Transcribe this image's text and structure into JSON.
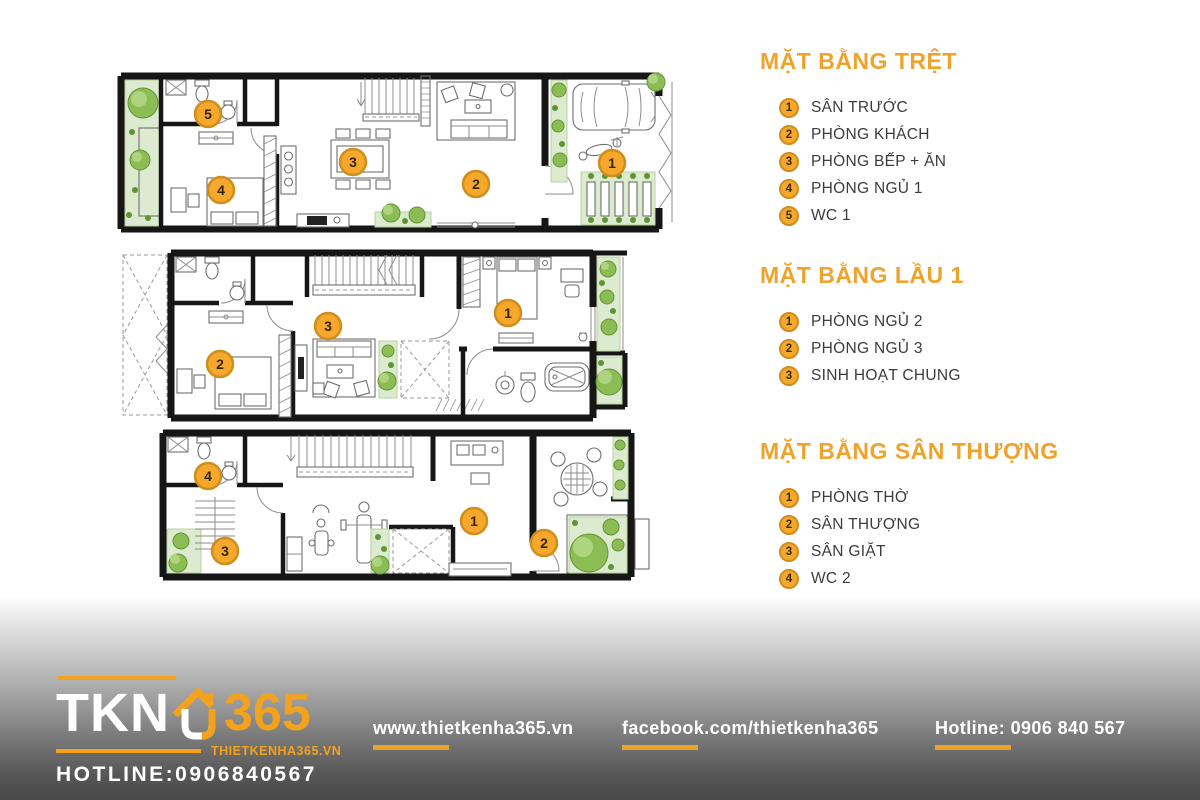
{
  "colors": {
    "accent": "#F0A42C",
    "marker_fill": "#F5A82B",
    "marker_border": "#CF8D1E",
    "legend_text": "#3C3C3C",
    "wall": "#161616",
    "garden_green": "#DCEAD0",
    "tree_green": "#8CBD54",
    "footer_dark": "#494949"
  },
  "legend": {
    "sections": [
      {
        "title": "MẶT BẰNG TRỆT",
        "items": [
          {
            "num": "1",
            "label": "SÂN TRƯỚC"
          },
          {
            "num": "2",
            "label": "PHÒNG KHÁCH"
          },
          {
            "num": "3",
            "label": "PHÒNG BẾP + ĂN"
          },
          {
            "num": "4",
            "label": "PHÒNG NGỦ 1"
          },
          {
            "num": "5",
            "label": "WC 1"
          }
        ]
      },
      {
        "title": "MẶT BẰNG LẦU 1",
        "items": [
          {
            "num": "1",
            "label": "PHÒNG NGỦ 2"
          },
          {
            "num": "2",
            "label": "PHÒNG NGỦ 3"
          },
          {
            "num": "3",
            "label": "SINH HOẠT CHUNG"
          }
        ]
      },
      {
        "title": "MẶT BẰNG SÂN THƯỢNG",
        "items": [
          {
            "num": "1",
            "label": "PHÒNG THỜ"
          },
          {
            "num": "2",
            "label": "SÂN THƯỢNG"
          },
          {
            "num": "3",
            "label": "SÂN GIẶT"
          },
          {
            "num": "4",
            "label": "WC 2"
          }
        ]
      }
    ]
  },
  "plans": [
    {
      "name": "mat-bang-tret",
      "markers": [
        {
          "num": "1",
          "x": 497,
          "y": 93
        },
        {
          "num": "2",
          "x": 361,
          "y": 114
        },
        {
          "num": "3",
          "x": 238,
          "y": 92
        },
        {
          "num": "4",
          "x": 106,
          "y": 120
        },
        {
          "num": "5",
          "x": 93,
          "y": 44
        }
      ]
    },
    {
      "name": "mat-bang-lau-1",
      "markers": [
        {
          "num": "1",
          "x": 393,
          "y": 68
        },
        {
          "num": "2",
          "x": 105,
          "y": 119
        },
        {
          "num": "3",
          "x": 213,
          "y": 81
        }
      ]
    },
    {
      "name": "mat-bang-san-thuong",
      "markers": [
        {
          "num": "1",
          "x": 359,
          "y": 96
        },
        {
          "num": "2",
          "x": 429,
          "y": 118
        },
        {
          "num": "3",
          "x": 110,
          "y": 126
        },
        {
          "num": "4",
          "x": 93,
          "y": 51
        }
      ]
    }
  ],
  "footer": {
    "logo": {
      "brand": "TKN",
      "brand_number": "365",
      "website_small": "THIETKENHA365.VN",
      "hotline_small": "HOTLINE:0906840567"
    },
    "links": [
      {
        "label": "www.thietkenha365.vn"
      },
      {
        "label": "facebook.com/thietkenha365"
      },
      {
        "label": "Hotline: 0906 840 567"
      }
    ]
  }
}
